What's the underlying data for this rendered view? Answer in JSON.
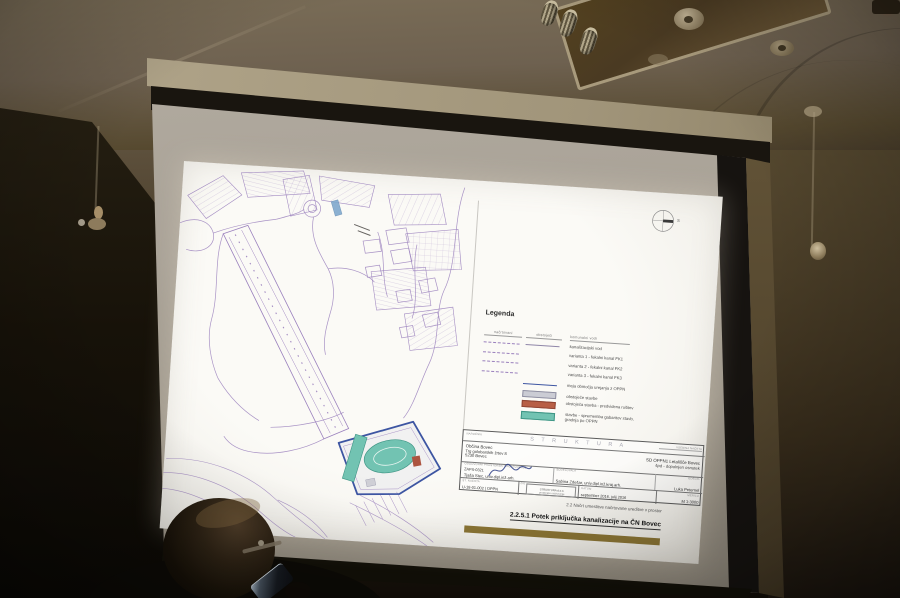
{
  "palette": {
    "map_line": "#9a80bd",
    "boundary_blue": "#3d55a2",
    "teal_fill": "#72c3b2",
    "teal_stroke": "#3f9585",
    "red_building": "#ad5540",
    "legend_gray": "#cbccd4",
    "legend_red": "#b85f46",
    "highlight_blue": "#7fa9cd",
    "gold_bar": "#8a7434"
  },
  "slide": {
    "north_label": "S",
    "legend": {
      "title": "Legenda",
      "columns": [
        "načrtovani",
        "obstoječi",
        "komunalni vodi"
      ],
      "rows": [
        {
          "label": "kanalizacijski vod"
        },
        {
          "label": "varianta 1 - fekalni kanal FK1"
        },
        {
          "label": "varianta 2 - fekalni kanal FK2"
        },
        {
          "label": "varianta 3 - fekalni kanal FK3"
        },
        {
          "label": "meja območja urejanja z OPPN"
        },
        {
          "label": "obstoječe stavbe"
        },
        {
          "label": "obstoječa stavba - predvidena rušitev"
        },
        {
          "label": "stavbe - sprememba gabaritov stavb,",
          "label2": "gradnja po OPPN"
        }
      ]
    },
    "title_block": {
      "watermark": "S T R U K T U R A",
      "client_label": "NAROČNIK",
      "client_lines": [
        "Občina Bovec",
        "Trg golobarskih žrtev 8",
        "5230 Bovec"
      ],
      "doc_label": "VSEBINA NAČRTA",
      "plan_lines": [
        "SD OPPN1 Letališče Bovec",
        "špd - dopolnjen osnutek"
      ],
      "designer_label": "ODGOVORNI PROSTORSKI NAČRTOVALEC",
      "designer_id": "ZAPS-0321",
      "designer_name": "Tjaša Stec, univ.dipl.inž.arh.",
      "collab_label": "SODELOVALA",
      "collab_name": "Sabina Zdešar, univ.dipl.inž.kraj.arh.",
      "drafter_label": "IZDELAL",
      "drafter_name": "Luka Peternel",
      "cells": {
        "project_label": "ŠT. NAČRTA",
        "project_no": "U-18-01-002 | OPPN",
        "stamp_label": "ŽIG",
        "stamp_lines": [
          "STRUKTURA d.o.o.",
          "prostorsko načrtovanje"
        ],
        "date_label": "DATUM",
        "date": "september 2016, julij 2016",
        "scale_label": "MERILO",
        "scale": "M 1:3000"
      }
    },
    "footer": {
      "section": "2.2 Načrt umestitve načrtovane ureditve v prostor",
      "title": "2.2.5.1 Potek priključka kanalizacije na ČN Bovec"
    }
  }
}
